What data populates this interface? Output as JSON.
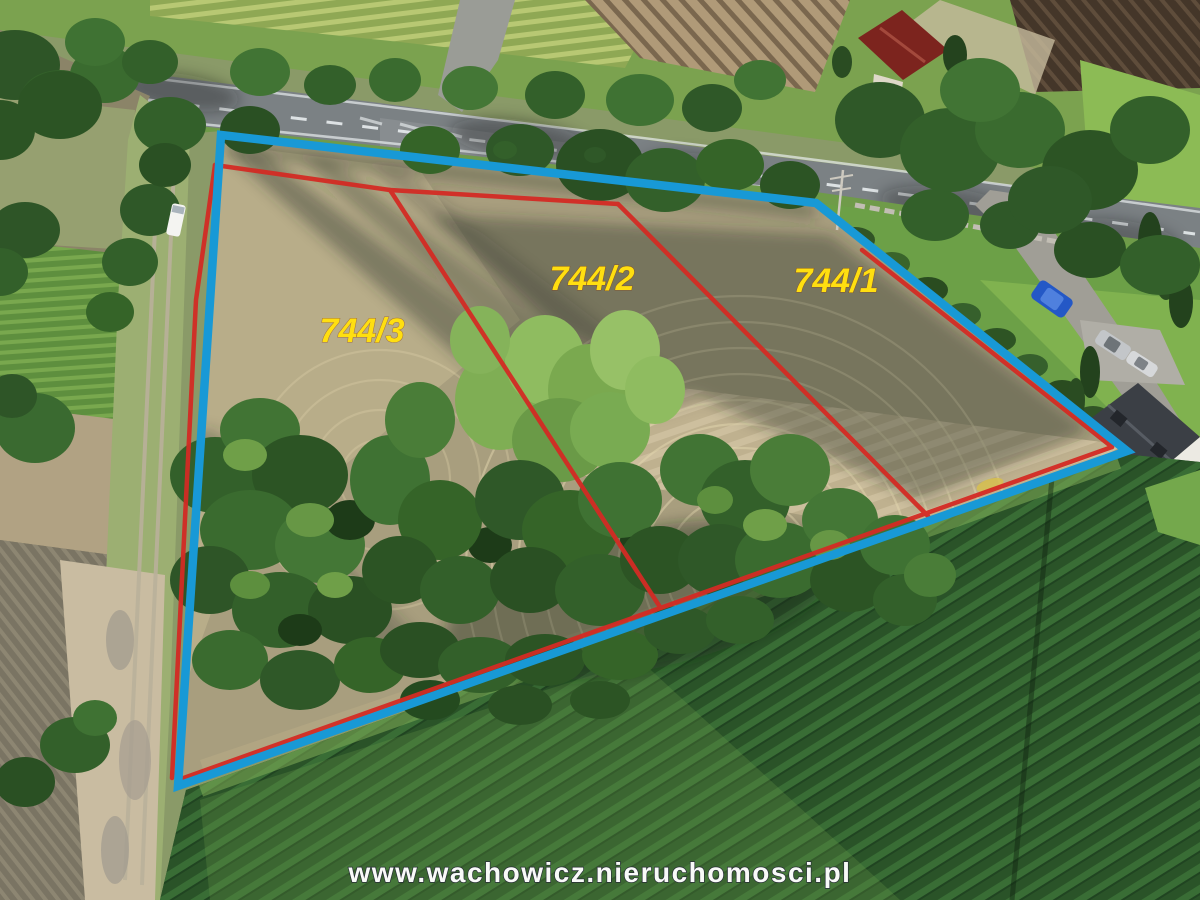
{
  "overlay": {
    "boundary_color": "#1899d6",
    "line_color": "#d32b24",
    "label_color": "#ffdf10",
    "parcels": [
      {
        "label": "744/3"
      },
      {
        "label": "744/2"
      },
      {
        "label": "744/1"
      }
    ]
  },
  "watermark": {
    "text": "www.wachowicz.nieruchomosci.pl",
    "color": "#ffffff"
  }
}
